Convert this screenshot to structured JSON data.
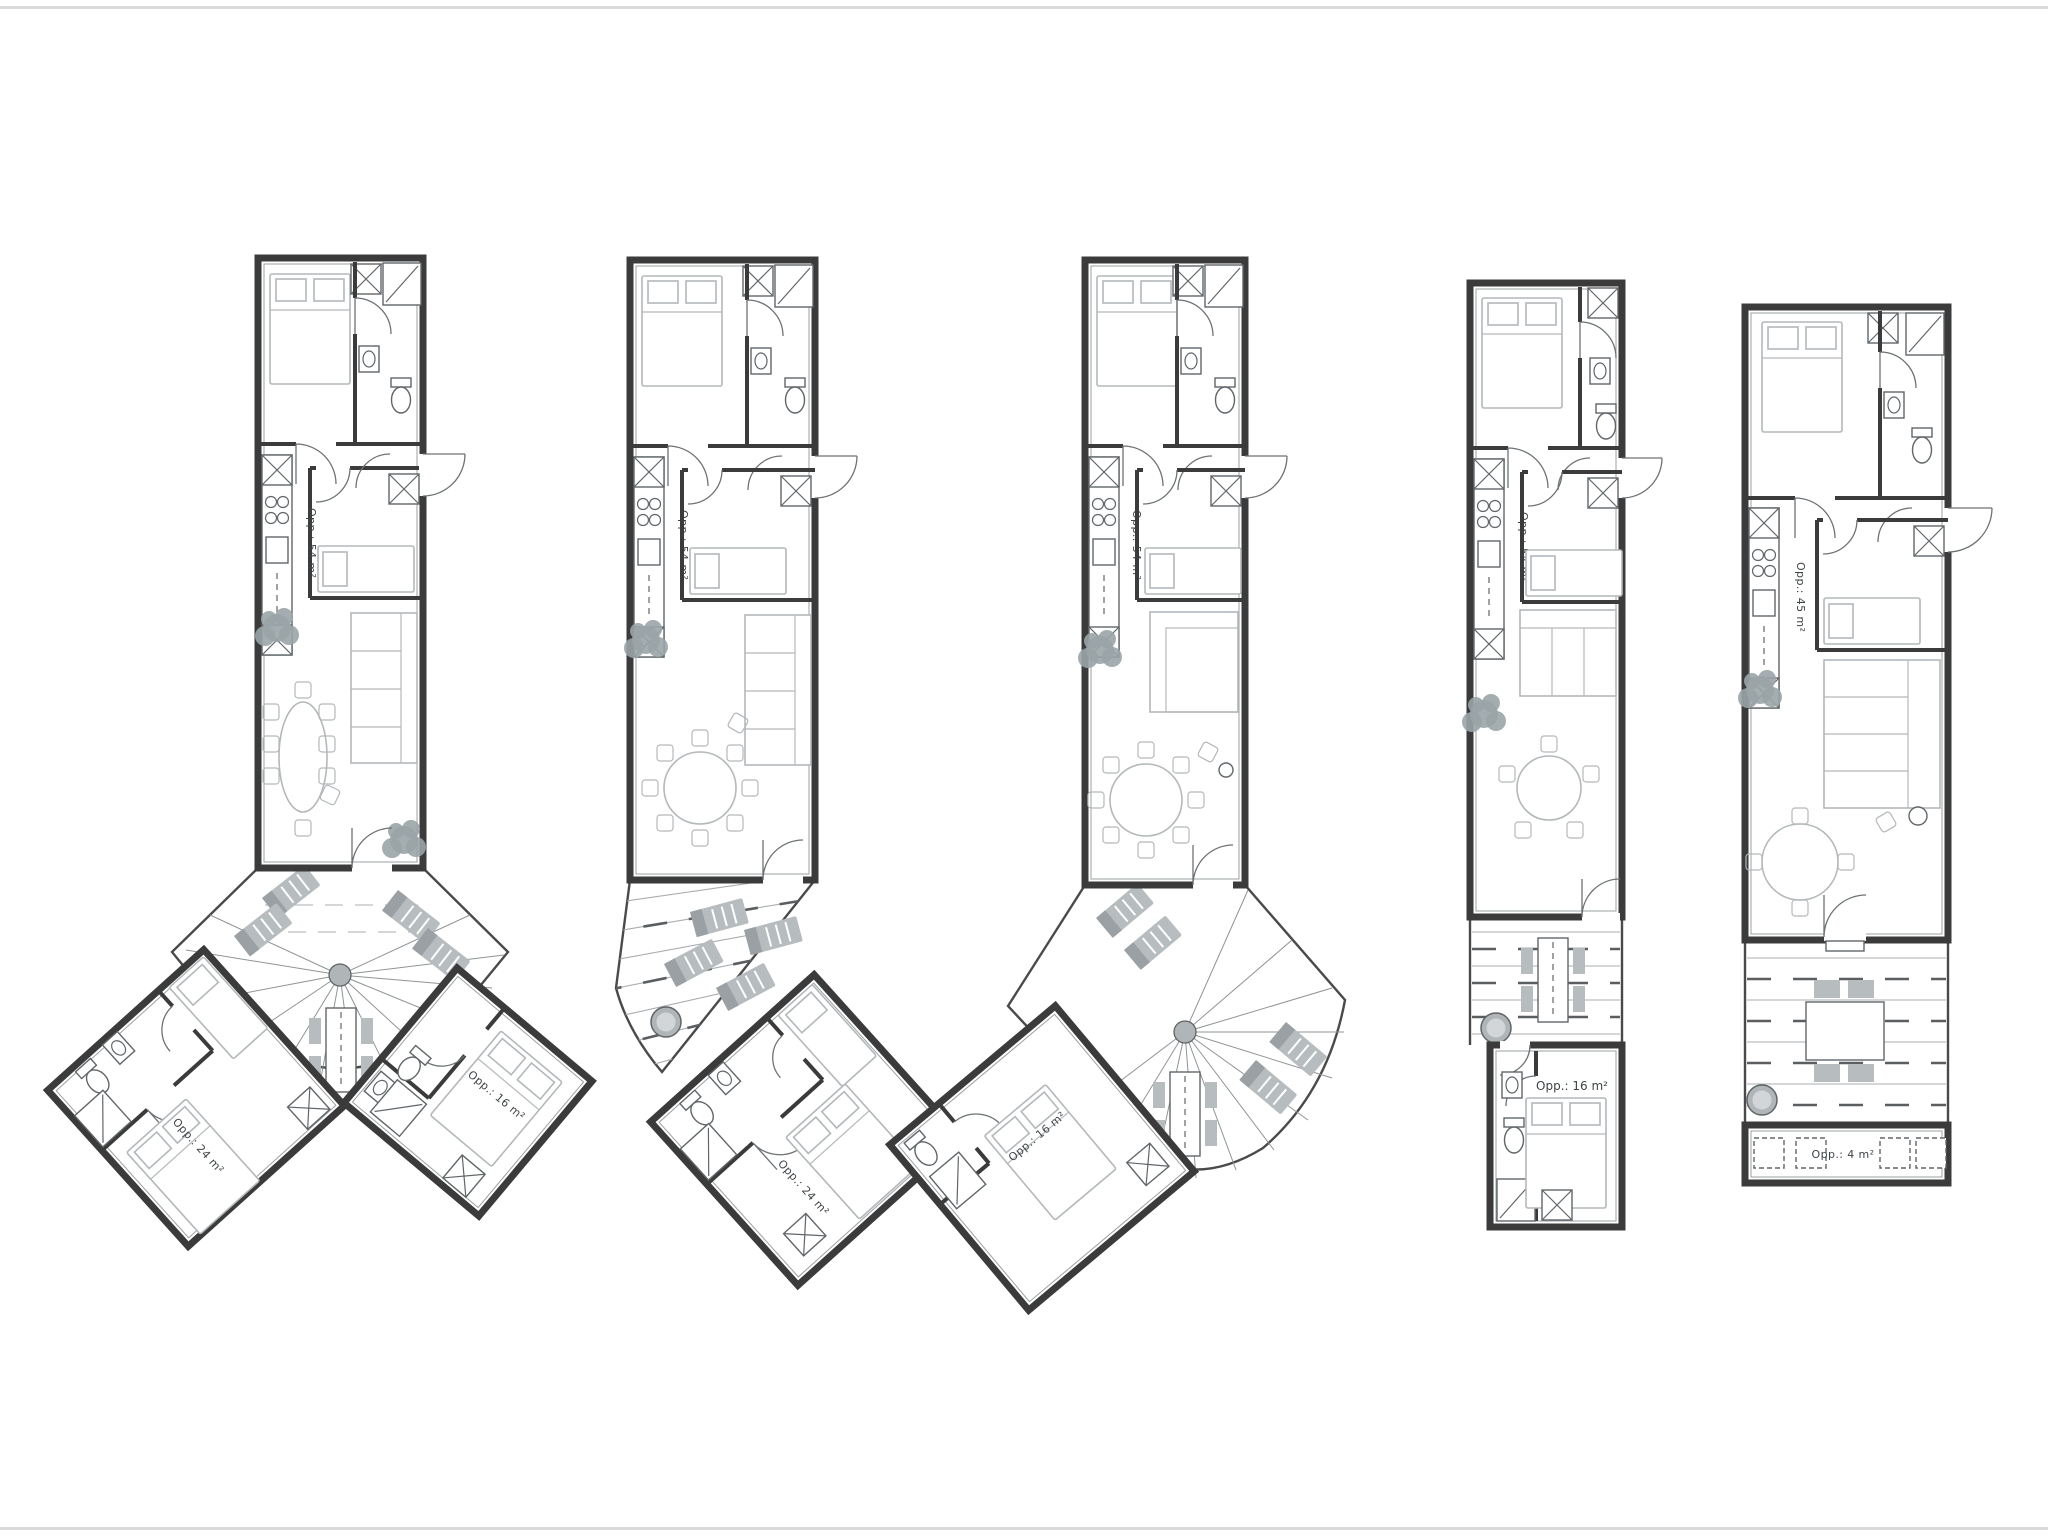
{
  "page": {
    "background": "#ffffff",
    "sheet_type": "floor-plan-drawing"
  },
  "colors": {
    "wall": "#3b3b3b",
    "thin_line": "#9aa0a3",
    "furniture_light": "#b3b8ba",
    "fixture": "#606669",
    "deck_outline": "#4a4a4a",
    "deck_furniture": "#b7bcbe",
    "plant": "#9aa4a7",
    "label_text": "#3f4447"
  },
  "plans": [
    {
      "id": "plan-1",
      "layout": "y-shape-fan-deck-two-wings",
      "main_area": "Opp.: 54 m²",
      "left_wing_area": "Opp.: 24 m²",
      "right_wing_area": "Opp.: 16 m²"
    },
    {
      "id": "plan-2",
      "layout": "angled-plank-deck-one-wing",
      "main_area": "Opp.: 54 m²",
      "wing_area": "Opp.: 24 m²"
    },
    {
      "id": "plan-3",
      "layout": "fan-deck-one-wing",
      "main_area": "Opp.: 54 m²",
      "wing_area": "Opp.: 16 m²"
    },
    {
      "id": "plan-4",
      "layout": "linear-deck-annex",
      "main_area": "Opp.: 54 m²",
      "annex_area": "Opp.: 16 m²"
    },
    {
      "id": "plan-5",
      "layout": "linear-wide-deck-planters",
      "main_area": "Opp.: 45 m²",
      "planter_area": "Opp.: 4 m²"
    }
  ]
}
